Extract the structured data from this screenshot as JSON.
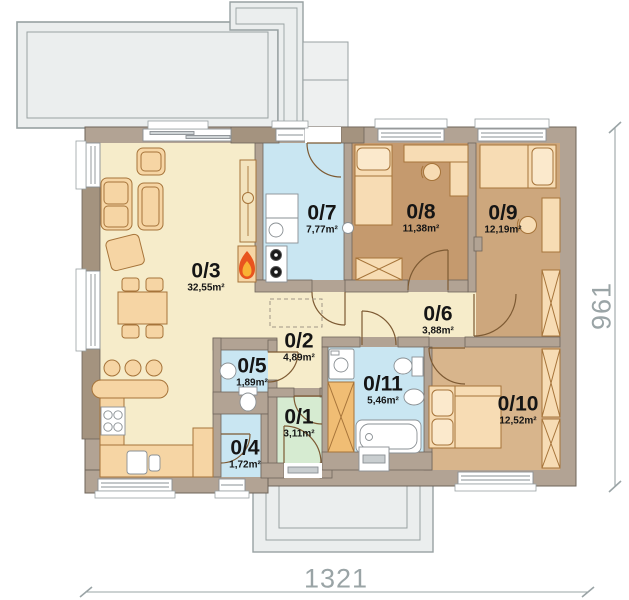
{
  "plan": {
    "type": "floor-plan",
    "rooms": [
      {
        "id": "0/1",
        "area": "3,11m²",
        "color": "#d6ebd1"
      },
      {
        "id": "0/2",
        "area": "4,89m²",
        "color": "#f6ecca"
      },
      {
        "id": "0/3",
        "area": "32,55m²",
        "color": "#f6ecca"
      },
      {
        "id": "0/4",
        "area": "1,72m²",
        "color": "#c9e6f2"
      },
      {
        "id": "0/5",
        "area": "1,89m²",
        "color": "#c9e6f2"
      },
      {
        "id": "0/6",
        "area": "3,88m²",
        "color": "#f6ecca"
      },
      {
        "id": "0/7",
        "area": "7,77m²",
        "color": "#c9e6f2"
      },
      {
        "id": "0/8",
        "area": "11,38m²",
        "color": "#c59a6e"
      },
      {
        "id": "0/9",
        "area": "12,19m²",
        "color": "#cda77d"
      },
      {
        "id": "0/10",
        "area": "12,52m²",
        "color": "#d8b58c"
      },
      {
        "id": "0/11",
        "area": "5,46m²",
        "color": "#c9e6f2"
      }
    ],
    "dimensions": {
      "width_label": "1321",
      "height_label": "961"
    },
    "icons": [
      {
        "name": "fireplace-flame-icon",
        "colors": [
          "#e8541e",
          "#f9b234"
        ]
      }
    ],
    "palette": {
      "wall": "#b2a394",
      "wall_dark": "#a4937f",
      "wall_edge": "#6f645a",
      "terrace": "#ebeeee",
      "outline_gray": "#98a1a2",
      "furniture": "#f6d5a4",
      "furniture_edge": "#a6743a",
      "dimension_text": "#9aa4a6"
    }
  }
}
